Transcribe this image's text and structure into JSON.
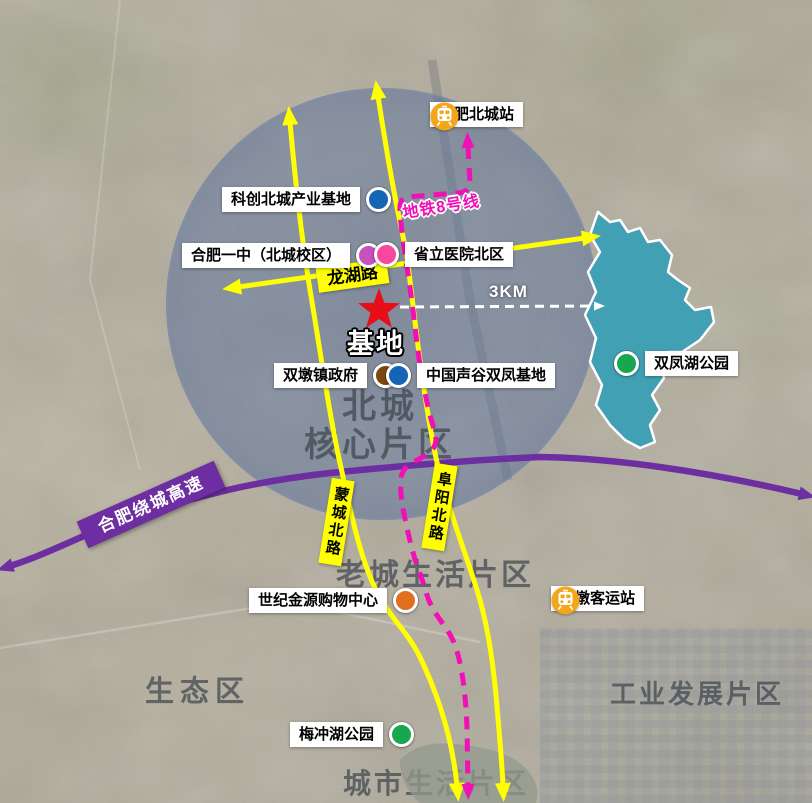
{
  "colors": {
    "road_yellow": "#ffff00",
    "metro_magenta": "#f10fb6",
    "highway_purple": "#6c2ea0",
    "lake_teal": "#42a0b4",
    "small_lake_gray": "#939a8d",
    "star_red": "#e60e18",
    "station_icon_yellow": "#f2a71b",
    "circle_blue": "rgba(100,122,163,0.5)",
    "scale_white": "#ffffff",
    "district_text": "rgba(56,63,74,0.68)"
  },
  "site": {
    "marker_label": "基地"
  },
  "scale": {
    "label": "3KM"
  },
  "metro": {
    "label": "地铁8号线"
  },
  "highway": {
    "label": "合肥绕城高速"
  },
  "roads": {
    "longhu": "龙湖路",
    "mengcheng": "蒙城北路",
    "fuyang": "阜阳北路"
  },
  "stations": [
    {
      "label": "合肥北城站"
    },
    {
      "label": "双墩客运站"
    }
  ],
  "pois": [
    {
      "label": "科创北城产业基地",
      "dot": "#1565b4"
    },
    {
      "label": "合肥一中（北城校区）",
      "dot": "#c750bd"
    },
    {
      "label": "省立医院北区",
      "dot": "#f7479f"
    },
    {
      "label": "双墩镇政府",
      "dot": "#7e4612"
    },
    {
      "label": "中国声谷双凤基地",
      "dot": "#1565b4"
    },
    {
      "label": "双凤湖公园",
      "dot": "#17a74e"
    },
    {
      "label": "世纪金源购物中心",
      "dot": "#e0701f"
    },
    {
      "label": "梅冲湖公园",
      "dot": "#17a74e"
    }
  ],
  "districts": {
    "beicheng_core": {
      "line1": "北城",
      "line2": "核心片区"
    },
    "laocheng": {
      "label": "老城生活片区"
    },
    "shengtai": {
      "label": "生态区"
    },
    "gongye": {
      "label": "工业发展片区"
    },
    "chengshi": {
      "label": "城市生活片区"
    }
  }
}
